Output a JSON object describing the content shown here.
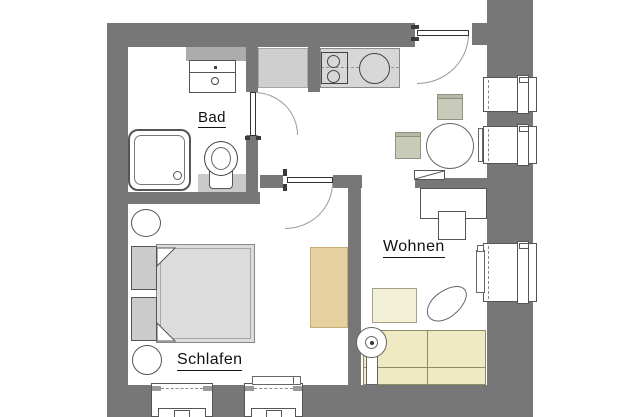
{
  "title": "Apartment floor plan",
  "rooms": {
    "bathroom": {
      "label": "Bad"
    },
    "living": {
      "label": "Wohnen"
    },
    "bedroom": {
      "label": "Schlafen"
    }
  },
  "fixtures": [
    "shower",
    "toilet",
    "washbasin",
    "bathroom-shelf",
    "kitchen-cabinet",
    "kitchen-counter",
    "stove-two-burners",
    "kitchen-sink",
    "entrance-door",
    "bathroom-door",
    "bedroom-door",
    "dining-table",
    "dining-chair",
    "dining-chair",
    "sideboard",
    "desk",
    "desk-chair",
    "double-bed",
    "nightstand",
    "nightstand",
    "pillow",
    "pillow",
    "stool",
    "stool",
    "rug",
    "sofa",
    "coffee-table",
    "pouf",
    "floor-lamp",
    "window",
    "window",
    "window",
    "window",
    "window",
    "radiator",
    "radiator",
    "radiator"
  ],
  "colors": {
    "wall": "#777777",
    "floor": "#ffffff",
    "counter": "#d7d7d7",
    "cabinet": "#cfcfcf",
    "shelf": "#acacac",
    "wcblock": "#c9c9c9",
    "mattress": "#dcdcdc",
    "nightstand": "#cbcbcb",
    "rug": "#e7d1a0",
    "rugline": "#c8ae74",
    "sofa": "#efeac2",
    "sofaline": "#8f8b66",
    "coffee": "#f3f0d8",
    "chair": "#c7cbb7",
    "line": "#555555",
    "text": "#111111"
  }
}
